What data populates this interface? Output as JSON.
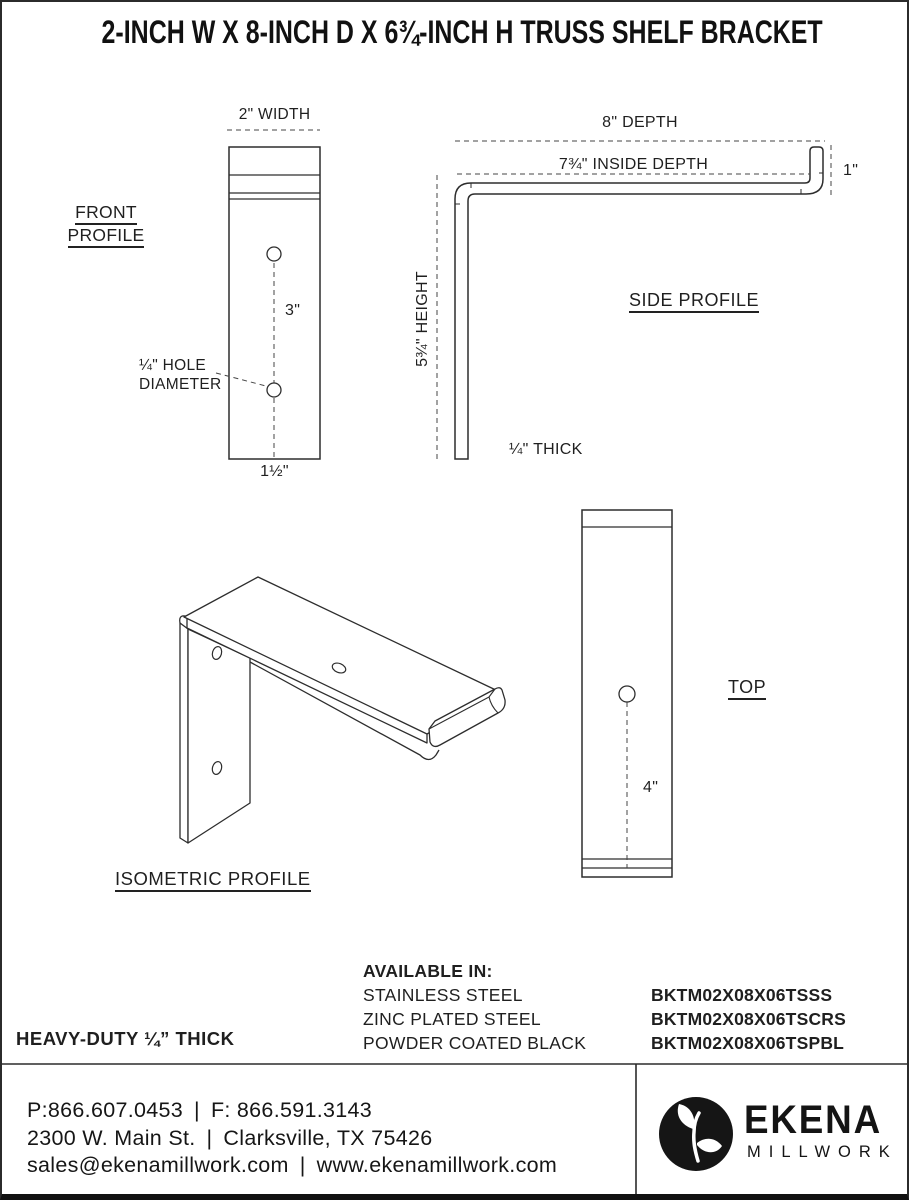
{
  "page": {
    "title": "2-INCH W X 8-INCH D X 6¾-INCH H TRUSS SHELF BRACKET"
  },
  "views": {
    "front": {
      "label_line1": "FRONT",
      "label_line2": "PROFILE",
      "width_dim": "2\" WIDTH",
      "hole_spacing_dim": "3\"",
      "hole_dia_line1": "¼\" HOLE",
      "hole_dia_line2": "DIAMETER",
      "bottom_offset_dim": "1½\""
    },
    "side": {
      "label": "SIDE PROFILE",
      "depth_dim": "8\" DEPTH",
      "inside_depth_dim": "7¾\" INSIDE DEPTH",
      "lip_height_dim": "1\"",
      "height_dim": "5¾\" HEIGHT",
      "thickness_dim": "¼\" THICK"
    },
    "isometric": {
      "label": "ISOMETRIC PROFILE"
    },
    "top": {
      "label": "TOP",
      "hole_offset_dim": "4\""
    }
  },
  "availability": {
    "heading": "AVAILABLE IN:",
    "options": [
      {
        "finish": "STAINLESS STEEL",
        "sku": "BKTM02X08X06TSSS"
      },
      {
        "finish": "ZINC PLATED STEEL",
        "sku": "BKTM02X08X06TSCRS"
      },
      {
        "finish": "POWDER COATED BLACK",
        "sku": "BKTM02X08X06TSPBL"
      }
    ]
  },
  "notes": {
    "heavy_duty": "HEAVY-DUTY ¼” THICK"
  },
  "footer": {
    "phone": "P:866.607.0453",
    "fax": "F: 866.591.3143",
    "separator": "|",
    "address": "2300 W. Main St.",
    "city_state": "Clarksville, TX 75426",
    "email": "sales@ekenamillwork.com",
    "website": "www.ekenamillwork.com",
    "brand": {
      "name": "EKENA",
      "subtitle": "MILLWORK"
    }
  },
  "colors": {
    "line": "#2d2d2d",
    "text": "#1c1c1c",
    "background": "#ffffff",
    "accent_black": "#151515"
  }
}
